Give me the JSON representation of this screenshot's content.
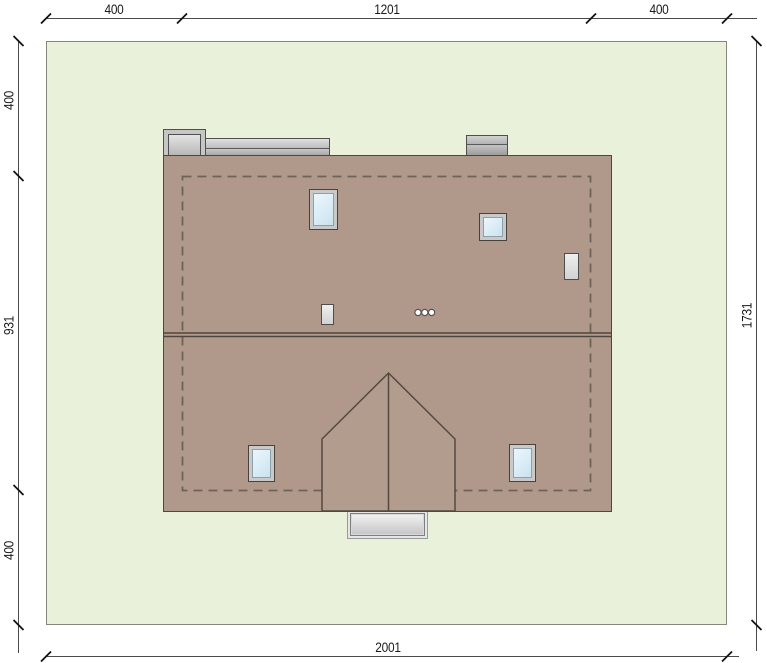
{
  "drawing": {
    "type": "roof-plan",
    "dimensions": {
      "top": [
        "400",
        "1201",
        "400"
      ],
      "left": [
        "400",
        "931",
        "400"
      ],
      "right": [
        "1731"
      ],
      "bottom": [
        "2001"
      ]
    },
    "colors": {
      "plot_grass": "#e9f1da",
      "plot_border": "#83887a",
      "roof": "#b0998b",
      "roof_edge": "#4f463e",
      "wall_outline_dashed": "#6f6257",
      "skylight_glass": "#d9ecf6",
      "skylight_frame": "#c9c9c9",
      "chimney_gray": "#c6c6c6",
      "porch_gray": "#d9d9d9",
      "dimension_line": "#4a4a4a",
      "dimension_text": "#1a1a1a"
    },
    "elements": {
      "skylights": 4,
      "chimneys": 2,
      "roof_vents": 2,
      "vent_pipes": 3,
      "dormers": 1,
      "entrance_porches": 1
    }
  }
}
